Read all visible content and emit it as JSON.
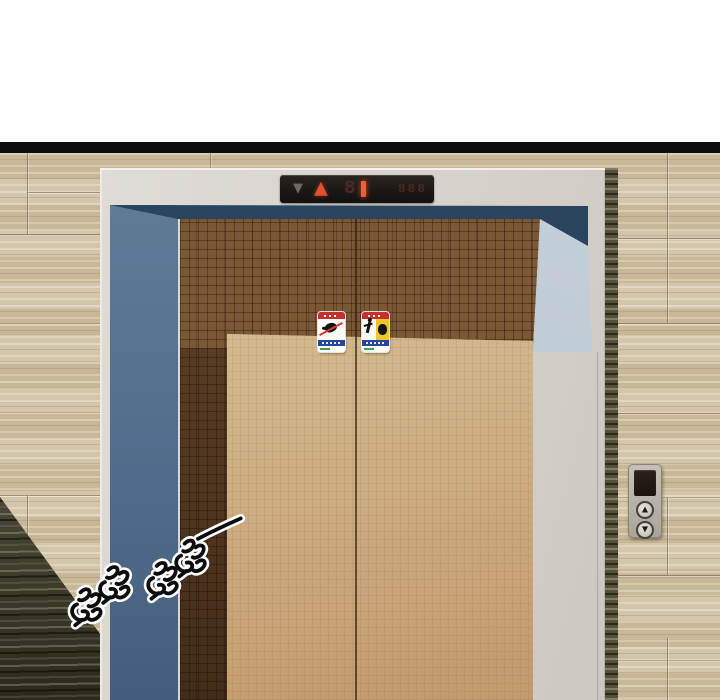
{
  "scene": {
    "type": "webtoon comic panel",
    "description": "Closed elevator with bronze doors set in a travertine-tiled wall; hall lantern above the doors shows the up arrow lit; a call-button panel is on the right wall; a hand-drawn rumbling sound effect appears at the lower left."
  },
  "hall_lantern": {
    "down_symbol": "▼",
    "up_symbol": "▲",
    "dim_digit": "8",
    "lit_segment": "1",
    "faint_text": "888",
    "colors": {
      "down": "#6b6b67",
      "up": "#e2512e",
      "lit": "#ff5a36",
      "dim_digit": "#462b23",
      "strip_bg": "#1d1916"
    }
  },
  "door_stickers": {
    "left": {
      "icon": "no-touching-door-hand-pictogram",
      "header_color": "#c4302b",
      "footer_color": "#27479e"
    },
    "right": {
      "icon": "caution-falling-figure-pictogram",
      "header_color": "#c4302b",
      "footer_color": "#27479e",
      "panel_color": "#f0c525"
    }
  },
  "call_panel": {
    "up_symbol": "▲",
    "down_symbol": "▼"
  },
  "sfx": {
    "text": "哆哆 哆哆 ——",
    "style": "hand-drawn black glyphs with white outline, tilted, with trailing dash"
  },
  "palette": {
    "panel_border": "#0d0d0d",
    "wall": "#cfc0a0",
    "wall_dark_wedge": "#3f3a28",
    "frame": "#d8d4cf",
    "reveal_navy": "#28425c",
    "reveal_blue": "#53708c",
    "reveal_light": "#bfcbd5",
    "door_upper": "#7a5835",
    "door_lower": "#cdab7e"
  }
}
